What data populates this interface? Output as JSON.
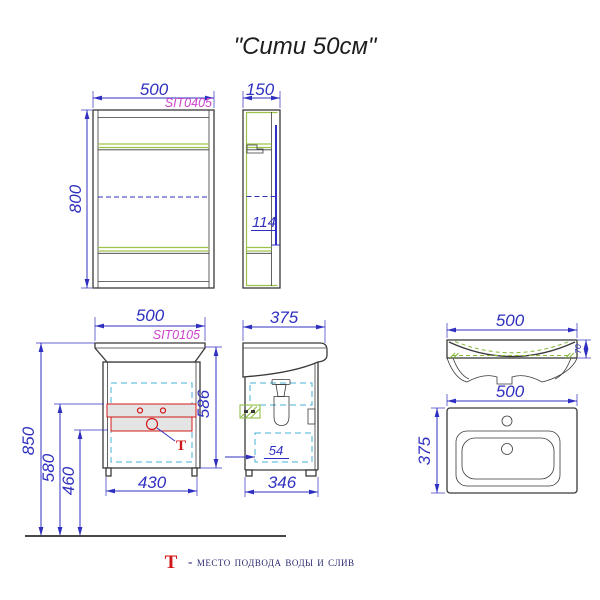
{
  "title": "\"Сити 50см\"",
  "legend": {
    "symbol": "Т",
    "text": "- место подвода воды и слив"
  },
  "colors": {
    "dimension_blue": "#3030c0",
    "code_magenta": "#cc44cc",
    "marker_red": "#d01818",
    "shelf_green": "#9dc24a",
    "hidden_cyan": "#45b0d5",
    "outline": "#3a3a3a"
  },
  "mirror_cabinet": {
    "front": {
      "code": "SIT0405",
      "width": "500",
      "height": "800"
    },
    "side": {
      "depth": "150",
      "inner_depth": "114"
    }
  },
  "vanity": {
    "front": {
      "code": "SIT0105",
      "width": "500",
      "mount_height": "850",
      "supply_height": "580",
      "drain_height": "460",
      "body_height": "586",
      "bottom_width": "430",
      "t_symbol": "Т"
    },
    "side": {
      "depth": "375",
      "wall_gap": "54",
      "bottom_depth": "346"
    }
  },
  "basin": {
    "front": {
      "width": "500",
      "rim_height": "70"
    },
    "top": {
      "width": "500",
      "depth": "375"
    }
  }
}
